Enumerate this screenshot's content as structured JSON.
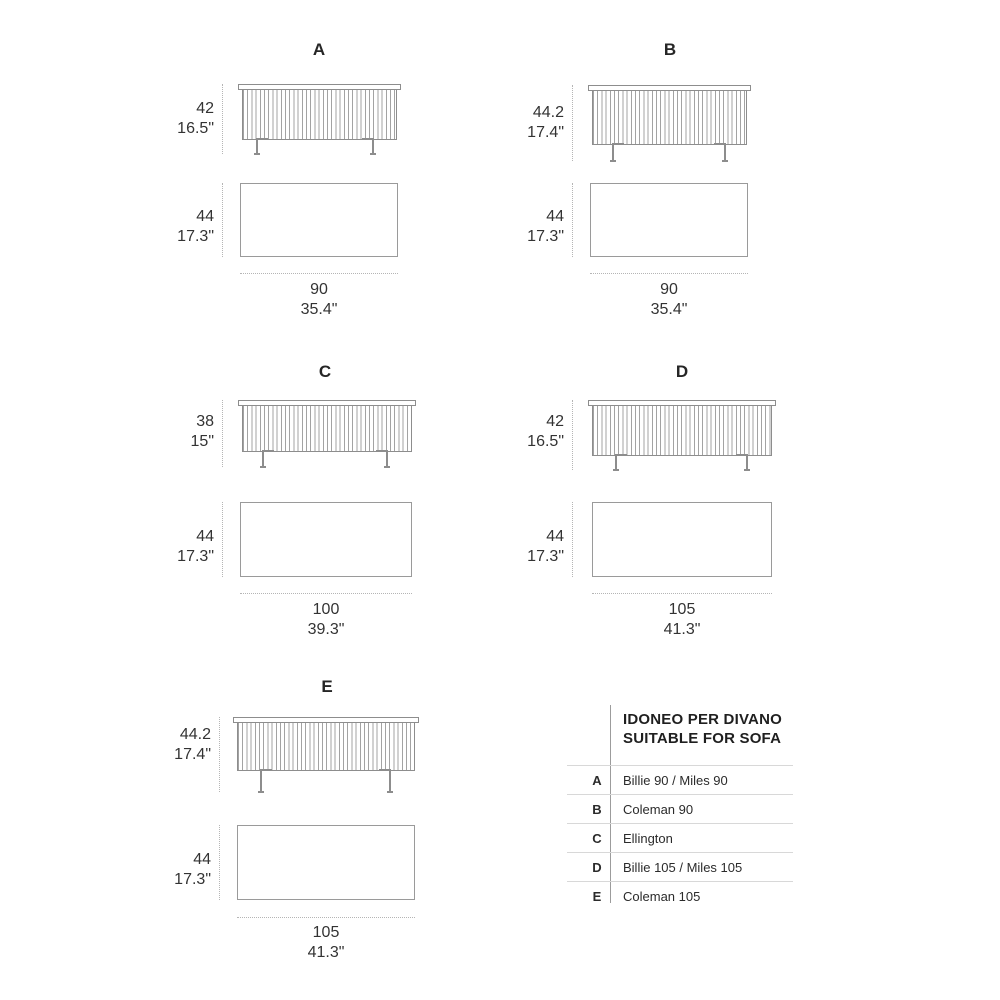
{
  "panels": [
    {
      "label": "A",
      "front_cm": "42",
      "front_in": "16.5\"",
      "plan_cm": "44",
      "plan_in": "17.3\"",
      "width_cm": "90",
      "width_in": "35.4\""
    },
    {
      "label": "B",
      "front_cm": "44.2",
      "front_in": "17.4\"",
      "plan_cm": "44",
      "plan_in": "17.3\"",
      "width_cm": "90",
      "width_in": "35.4\""
    },
    {
      "label": "C",
      "front_cm": "38",
      "front_in": "15\"",
      "plan_cm": "44",
      "plan_in": "17.3\"",
      "width_cm": "100",
      "width_in": "39.3\""
    },
    {
      "label": "D",
      "front_cm": "42",
      "front_in": "16.5\"",
      "plan_cm": "44",
      "plan_in": "17.3\"",
      "width_cm": "105",
      "width_in": "41.3\""
    },
    {
      "label": "E",
      "front_cm": "44.2",
      "front_in": "17.4\"",
      "plan_cm": "44",
      "plan_in": "17.3\"",
      "width_cm": "105",
      "width_in": "41.3\""
    }
  ],
  "sofa_table": {
    "title_line1": "IDONEO PER DIVANO",
    "title_line2": "SUITABLE FOR SOFA",
    "rows": [
      {
        "key": "A",
        "value": "Billie 90 / Miles 90"
      },
      {
        "key": "B",
        "value": "Coleman 90"
      },
      {
        "key": "C",
        "value": "Ellington"
      },
      {
        "key": "D",
        "value": "Billie 105 / Miles 105"
      },
      {
        "key": "E",
        "value": "Coleman 105"
      }
    ]
  },
  "colors": {
    "drawing_line": "#8d8d8d",
    "plan_line": "#9a9a9a",
    "dimension_dotted_line": "#b5b5b5",
    "text": "#2d2d2d",
    "table_separator": "#d8d8d8",
    "table_divider": "#9c9c9c"
  }
}
